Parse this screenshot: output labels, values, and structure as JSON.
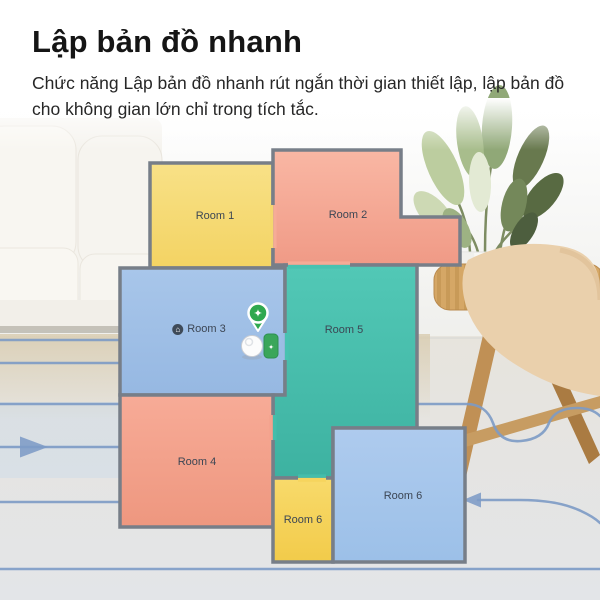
{
  "header": {
    "title": "Lập bản đồ nhanh",
    "subtitle": "Chức năng Lập bản đồ nhanh rút ngắn thời gian thiết lập, lập bản đồ cho không gian lớn chỉ trong tích tắc."
  },
  "floor_plan": {
    "wall_color": "#777e88",
    "label_color": "#3c4654",
    "rooms": [
      {
        "id": "room1",
        "label": "Room 1",
        "color": "#f6dc7e"
      },
      {
        "id": "room2",
        "label": "Room 2",
        "color": "#f6ad99"
      },
      {
        "id": "room3",
        "label": "Room 3",
        "color": "#a2c2e6",
        "has_marker": true
      },
      {
        "id": "room4",
        "label": "Room 4",
        "color": "#f3a28e"
      },
      {
        "id": "room5",
        "label": "Room 5",
        "color": "#4cc5b2"
      },
      {
        "id": "room6_small",
        "label": "Room 6",
        "color": "#f6d45e"
      },
      {
        "id": "room6_large",
        "label": "Room 6",
        "color": "#a6c6ea"
      }
    ]
  },
  "robot": {
    "badge_color": "#2fa84f",
    "dock_color": "#3aa65a"
  },
  "icons": {
    "badge_sparkle": "✦",
    "dock_sparkle": "✦",
    "room3_marker": "⌂"
  },
  "path_lines": {
    "color": "#7d9bc6"
  }
}
